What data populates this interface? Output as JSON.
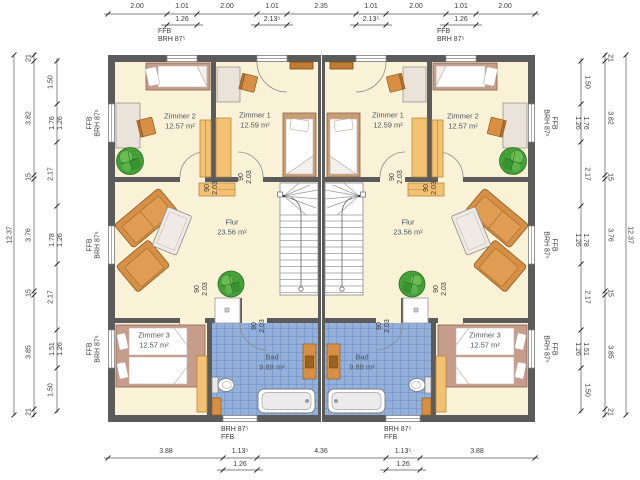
{
  "plan": {
    "rooms": {
      "zimmer2_left": {
        "name": "Zimmer 2",
        "area": "12.57 m²"
      },
      "zimmer1_left": {
        "name": "Zimmer 1",
        "area": "12.59 m²"
      },
      "zimmer1_right": {
        "name": "Zimmer 1",
        "area": "12.59 m²"
      },
      "zimmer2_right": {
        "name": "Zimmer 2",
        "area": "12.57 m²"
      },
      "flur_left": {
        "name": "Flur",
        "area": "23.56 m²"
      },
      "flur_right": {
        "name": "Flur",
        "area": "23.56 m²"
      },
      "zimmer3_left": {
        "name": "Zimmer 3",
        "area": "12.57 m²"
      },
      "zimmer3_right": {
        "name": "Zimmer 3",
        "area": "12.57 m²"
      },
      "bad_left": {
        "name": "Bad",
        "area": "9.88 m²"
      },
      "bad_right": {
        "name": "Bad",
        "area": "9.88 m²"
      }
    },
    "door": {
      "w": "90",
      "h": "2.03"
    },
    "win": {
      "ffb": "FFB",
      "brh": "BRH 87⁵"
    },
    "dims": {
      "top_main": [
        "2.00",
        "1.01",
        "2.00",
        "1.01",
        "2.35",
        "1.01",
        "2.00",
        "1.01",
        "2.00"
      ],
      "top_sub": [
        "1.26",
        "2.13⁵",
        "2.13⁵",
        "1.26"
      ],
      "bottom_main": [
        "3.88",
        "1.13⁵",
        "4.36",
        "1.13⁵",
        "3.88"
      ],
      "bottom_sub": [
        "1.26",
        "1.26"
      ],
      "side_total": "12.37",
      "side_middle": [
        "21",
        "3.82",
        "15",
        "3.76",
        "15",
        "3.85",
        "21"
      ],
      "side_inner_main": [
        "1.50",
        "1.76",
        "2.17",
        "1.78",
        "2.17",
        "1.51",
        "1.50"
      ],
      "side_inner_sub": [
        "1.26",
        "1.26",
        "1.26"
      ]
    },
    "colors": {
      "wall": "#5b5b5b",
      "floor": "#faf2d6",
      "bath_tile": "#92b0da",
      "bath_tile_grid": "#6d8cc0",
      "furniture_orange": "#d98f43",
      "furniture_light": "#f3c172",
      "bed_frame": "#c69c8b",
      "plant_green": "#46a03a",
      "label_text": "#4a5560",
      "dim_text": "#3a3a3a"
    }
  }
}
